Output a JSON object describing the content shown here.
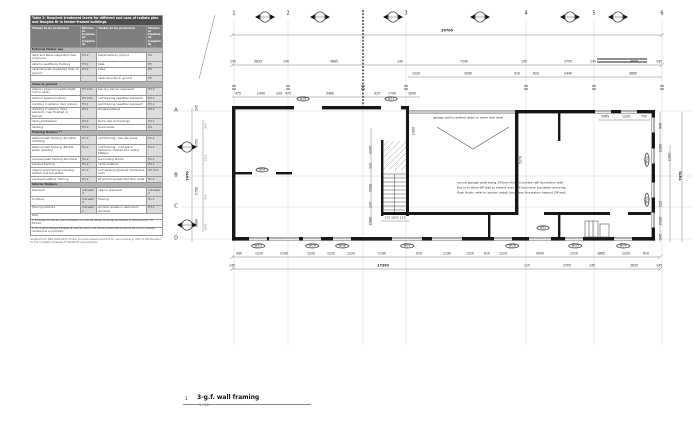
{
  "sheet": {
    "number": "1",
    "title": "3-g.f. wall framing",
    "scale": "1 : 50"
  },
  "table": {
    "title": "Table 2: Required treatment levels for different end uses of radiata pine and Douglas fir in timber-framed buildings",
    "col_headers": [
      "Timber to be protected",
      "Minimum treatment (required)",
      "Timber to be protected",
      "Minimum treatment (required)"
    ],
    "sections": [
      {
        "h": "External timber use",
        "rows": [
          [
            "deck and stairs supported clear of ground",
            "H3.2",
            "balustrades to ground",
            "H4"
          ],
          [
            "exterior wall/fence framing",
            "H3.2",
            "piles",
            "H5"
          ],
          [
            "veranda posts supported clear of ground",
            "H3.2",
            "poles",
            "H5"
          ],
          [
            "",
            "",
            "veranda posts in ground",
            "H5"
          ]
        ]
      },
      {
        "h": "Close to ground",
        "rows": [
          [
            "exterior plywood (weathertight roof or deck)",
            "H3 CCA",
            "balcony barrier (exposed)",
            "H3.2"
          ],
          [
            "exterior plywood (other)",
            "H3 CCA",
            "roof framing (weather exposed)",
            "H3.1"
          ],
          [
            "cladding in exterior door joinery",
            "H3.1",
            "wall framing (weather exposed)",
            "H3.2"
          ],
          [
            "cladding in exterior (face painted), clear finished or stained",
            "H3.1",
            "shingles/shakes",
            "H3.2"
          ],
          [
            "deck jack/bearers",
            "H3.2",
            "fence rails and palings",
            "H3.1"
          ],
          [
            "decking",
            "H3.2",
            "fence posts",
            "H4"
          ]
        ]
      },
      {
        "h": "Framing timbers **",
        "rows": [
          [
            "external wall framing (brick/tile cladding)",
            "H1.2",
            "roof framing - low risk areas",
            "H1.2"
          ],
          [
            "external wall framing (E2/AS1 walls) cladding",
            "H1.2",
            "roof framing - roof space exposure, trusses and ceiling battens",
            "H1.2"
          ],
          [
            "enclosed wall framing structural",
            "H1.2",
            "wall nailing blocks",
            "H1.2"
          ],
          [
            "parapet framing",
            "H1.2",
            "cavity battens",
            "H3.1"
          ],
          [
            "interior wall framing including bottom and top plates",
            "H1.2",
            "roof sarking (plywood membrane roof)",
            "H3 CCA"
          ],
          [
            "enclosed subfloor framing",
            "H1.2",
            "structural sandwiched floor joists",
            "H1.2"
          ]
        ]
      },
      {
        "h": "Interior timbers",
        "rows": [
          [
            "stairwork",
            "untreated",
            "interior stairwork",
            "untreated"
          ],
          [
            "furniture",
            "untreated",
            "flooring",
            "H1.2"
          ],
          [
            "flooring interiors",
            "untreated",
            "window reveals in aluminium windows",
            "H3.1"
          ]
        ]
      }
    ],
    "notes": [
      "Note:",
      "1. Douglas fir may be used untreated on low-risk design buildings as defined in Amendment 7 to E2/AS1.",
      "2. H1.2 boric-treated Douglas fir may be used in all framing applications where H1.2 boric-treated radiata pine is permitted."
    ],
    "source": "Adapted from NZS 3602:2003 Timber and wood-based products for use in building; refer to the standard for the complete schedule of treatment requirements."
  },
  "plan": {
    "labels": [
      {
        "n": "grid-col-1",
        "t": "1",
        "x": 234,
        "y": 14,
        "s": 5
      },
      {
        "n": "grid-col-2",
        "t": "2",
        "x": 288,
        "y": 14,
        "s": 5
      },
      {
        "n": "grid-col-3",
        "t": "3",
        "x": 406,
        "y": 14,
        "s": 5
      },
      {
        "n": "grid-col-4",
        "t": "4",
        "x": 526,
        "y": 14,
        "s": 5
      },
      {
        "n": "grid-col-5",
        "t": "5",
        "x": 594,
        "y": 14,
        "s": 5
      },
      {
        "n": "grid-col-6",
        "t": "6",
        "x": 662,
        "y": 14,
        "s": 5
      },
      {
        "n": "grid-row-a",
        "t": "A",
        "x": 176,
        "y": 111,
        "s": 5
      },
      {
        "n": "grid-row-b",
        "t": "B",
        "x": 176,
        "y": 176,
        "s": 5
      },
      {
        "n": "grid-row-c",
        "t": "C",
        "x": 176,
        "y": 207,
        "s": 5
      },
      {
        "n": "grid-row-d",
        "t": "D",
        "x": 176,
        "y": 239,
        "s": 5
      },
      {
        "n": "dim-overall-width",
        "t": "24700",
        "x": 447,
        "y": 31,
        "s": 3.4,
        "b": 1
      },
      {
        "t": "145",
        "x": 233,
        "y": 62
      },
      {
        "t": "3635",
        "x": 258,
        "y": 62
      },
      {
        "t": "140",
        "x": 286,
        "y": 62
      },
      {
        "t": "4665",
        "x": 334,
        "y": 62
      },
      {
        "t": "140",
        "x": 400,
        "y": 62
      },
      {
        "t": "7240",
        "x": 464,
        "y": 62
      },
      {
        "t": "145",
        "x": 524,
        "y": 62
      },
      {
        "t": "3705",
        "x": 568,
        "y": 62
      },
      {
        "t": "145",
        "x": 593,
        "y": 62
      },
      {
        "t": "3635",
        "x": 634,
        "y": 62
      },
      {
        "t": "145",
        "x": 659,
        "y": 62
      },
      {
        "t": "1220",
        "x": 416,
        "y": 74
      },
      {
        "t": "3090",
        "x": 468,
        "y": 74
      },
      {
        "t": "910",
        "x": 517,
        "y": 74
      },
      {
        "t": "820",
        "x": 536,
        "y": 74
      },
      {
        "t": "2440",
        "x": 568,
        "y": 74
      },
      {
        "t": "3865",
        "x": 633,
        "y": 74
      },
      {
        "t": "475",
        "x": 238,
        "y": 94
      },
      {
        "t": "2440",
        "x": 261,
        "y": 94
      },
      {
        "t": "230",
        "x": 279,
        "y": 94
      },
      {
        "t": "475",
        "x": 288,
        "y": 94
      },
      {
        "t": "3460",
        "x": 330,
        "y": 94
      },
      {
        "t": "915",
        "x": 377,
        "y": 94
      },
      {
        "t": "1790",
        "x": 392,
        "y": 94
      },
      {
        "t": "1640",
        "x": 412,
        "y": 94
      },
      {
        "t": "1065",
        "x": 605,
        "y": 117
      },
      {
        "t": "1220",
        "x": 626,
        "y": 117
      },
      {
        "t": "750",
        "x": 644,
        "y": 117
      },
      {
        "n": "note-garage-wall",
        "t": "garage wall to extend down to lower slab level",
        "x": 433,
        "y": 118,
        "s": 3,
        "a": "l"
      },
      {
        "n": "note-sip-1",
        "t": "secure garage walls being 145mm thick. Concrete raft foundation with",
        "x": 457,
        "y": 183,
        "s": 3,
        "a": "l"
      },
      {
        "n": "note-sip-2",
        "t": "this is to allow SIP wall to extend over EPS boundary insulation ensuring",
        "x": 457,
        "y": 188,
        "s": 3,
        "a": "l"
      },
      {
        "n": "note-sip-3",
        "t": "flush finish; refer to section detail; boundary foundation beyond SIP wall",
        "x": 457,
        "y": 193,
        "s": 3,
        "a": "l"
      },
      {
        "t": "2105",
        "x": 371,
        "y": 150,
        "r": -90
      },
      {
        "t": "115",
        "x": 371,
        "y": 166,
        "r": -90
      },
      {
        "t": "3500",
        "x": 371,
        "y": 188,
        "r": -90
      },
      {
        "t": "115",
        "x": 371,
        "y": 205,
        "r": -90
      },
      {
        "t": "1560",
        "x": 371,
        "y": 221,
        "r": -90
      },
      {
        "t": "1400",
        "x": 414,
        "y": 131,
        "r": -90
      },
      {
        "t": "5170",
        "x": 521,
        "y": 160,
        "r": -90
      },
      {
        "t": "115 1620 115",
        "x": 395,
        "y": 218,
        "s": 3
      },
      {
        "t": "145",
        "x": 197,
        "y": 108,
        "r": -90
      },
      {
        "t": "3705",
        "x": 197,
        "y": 143,
        "r": -90
      },
      {
        "t": "1790",
        "x": 197,
        "y": 191,
        "r": -90
      },
      {
        "t": "1860",
        "x": 197,
        "y": 223,
        "r": -90
      },
      {
        "t": "7470",
        "x": 188,
        "y": 176,
        "r": -90,
        "s": 3.4,
        "b": 1
      },
      {
        "t": "985",
        "x": 206,
        "y": 126,
        "r": -90,
        "s": 2.8,
        "c": "#8a8a8a"
      },
      {
        "t": "1515",
        "x": 206,
        "y": 158,
        "r": -90,
        "s": 2.8,
        "c": "#8a8a8a"
      },
      {
        "t": "600",
        "x": 206,
        "y": 197,
        "r": -90,
        "s": 2.8,
        "c": "#8a8a8a"
      },
      {
        "t": "1495",
        "x": 206,
        "y": 227,
        "r": -90,
        "s": 2.8,
        "c": "#8a8a8a"
      },
      {
        "t": "940",
        "x": 661,
        "y": 126,
        "r": -90
      },
      {
        "t": "1100",
        "x": 661,
        "y": 148,
        "r": -90
      },
      {
        "t": "115",
        "x": 661,
        "y": 204,
        "r": -90
      },
      {
        "t": "2100",
        "x": 661,
        "y": 221,
        "r": -90
      },
      {
        "t": "145",
        "x": 661,
        "y": 237,
        "r": -90
      },
      {
        "t": "1165",
        "x": 670,
        "y": 157,
        "r": -90
      },
      {
        "t": "7470",
        "x": 681,
        "y": 176,
        "r": -90,
        "s": 3.4,
        "b": 1
      },
      {
        "t": "990",
        "x": 239,
        "y": 254
      },
      {
        "t": "1220",
        "x": 259,
        "y": 254
      },
      {
        "t": "2190",
        "x": 284,
        "y": 254
      },
      {
        "t": "1220",
        "x": 311,
        "y": 254
      },
      {
        "t": "1220",
        "x": 331,
        "y": 254
      },
      {
        "t": "1220",
        "x": 351,
        "y": 254
      },
      {
        "t": "2190",
        "x": 382,
        "y": 254
      },
      {
        "t": "910",
        "x": 419,
        "y": 254
      },
      {
        "t": "2190",
        "x": 447,
        "y": 254
      },
      {
        "t": "1220",
        "x": 470,
        "y": 254
      },
      {
        "t": "610",
        "x": 487,
        "y": 254
      },
      {
        "t": "1220",
        "x": 503,
        "y": 254
      },
      {
        "t": "4000",
        "x": 540,
        "y": 254
      },
      {
        "t": "1220",
        "x": 574,
        "y": 254
      },
      {
        "t": "1865",
        "x": 601,
        "y": 254
      },
      {
        "t": "1220",
        "x": 626,
        "y": 254
      },
      {
        "t": "610",
        "x": 646,
        "y": 254
      },
      {
        "t": "145",
        "x": 232,
        "y": 266
      },
      {
        "t": "17390",
        "x": 383,
        "y": 266,
        "s": 3.4,
        "b": 1
      },
      {
        "t": "115",
        "x": 527,
        "y": 266
      },
      {
        "t": "3705",
        "x": 567,
        "y": 266
      },
      {
        "t": "145",
        "x": 592,
        "y": 266
      },
      {
        "t": "3635",
        "x": 634,
        "y": 266
      },
      {
        "t": "145",
        "x": 659,
        "y": 266
      },
      {
        "n": "door-tag",
        "t": "D06",
        "x": 303,
        "y": 99,
        "tag": 1
      },
      {
        "n": "door-tag",
        "t": "D01",
        "x": 391,
        "y": 99,
        "tag": 1
      },
      {
        "n": "door-tag",
        "t": "D04",
        "x": 262,
        "y": 170,
        "tag": 1
      },
      {
        "n": "door-tag",
        "t": "D02",
        "x": 543,
        "y": 228,
        "tag": 1
      },
      {
        "n": "window-tag",
        "t": "W10",
        "x": 258,
        "y": 246,
        "tag": 1
      },
      {
        "n": "window-tag",
        "t": "W09",
        "x": 312,
        "y": 246,
        "tag": 1
      },
      {
        "n": "window-tag",
        "t": "W08",
        "x": 342,
        "y": 246,
        "tag": 1
      },
      {
        "n": "window-tag",
        "t": "W07",
        "x": 407,
        "y": 246,
        "tag": 1
      },
      {
        "n": "window-tag",
        "t": "W06",
        "x": 512,
        "y": 246,
        "tag": 1
      },
      {
        "n": "window-tag",
        "t": "W05",
        "x": 575,
        "y": 246,
        "tag": 1
      },
      {
        "n": "window-tag",
        "t": "W04",
        "x": 623,
        "y": 246,
        "tag": 1
      },
      {
        "n": "window-tag",
        "t": "W02",
        "x": 647,
        "y": 160,
        "r": -90,
        "tag": 1
      },
      {
        "n": "window-tag",
        "t": "W01",
        "x": 647,
        "y": 200,
        "r": -90,
        "tag": 1
      }
    ]
  }
}
